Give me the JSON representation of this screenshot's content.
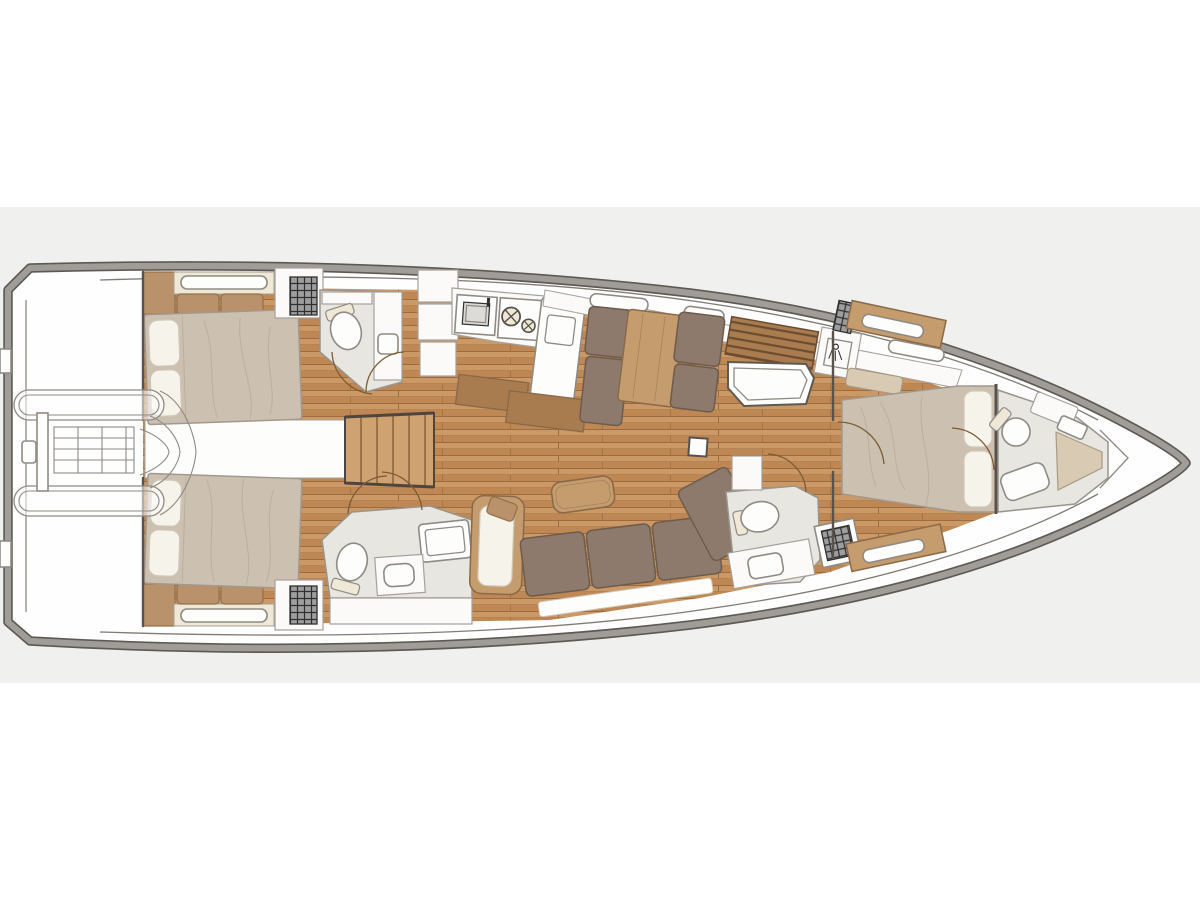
{
  "plan": {
    "type": "sailing-yacht-interior-floor-plan",
    "orientation": "bow-right"
  },
  "colors": {
    "background": "#ffffff",
    "band": "#f0f0ee",
    "hull_fill": "#fefefe",
    "hull_band": "#a09c97",
    "hull_edge": "#5e5952",
    "inner_line": "#807b74",
    "wall": "#57524c",
    "wood_light": "#cc9865",
    "wood_dark": "#bf8753",
    "wood_seam": "#9a6c40",
    "furniture_wood": "#c59c6e",
    "furniture_wood_edge": "#8a6a48",
    "stair_wood": "#cfa371",
    "stair_riser": "#9c7347",
    "stair_rail": "#4e463e",
    "cushion_dark": "#8d7a6c",
    "cushion_dark_edge": "#6d5c4c",
    "cushion_tan": "#b9916a",
    "cushion_tan_edge": "#93704e",
    "duvet": "#ccc0b1",
    "duvet_edge": "#a2988c",
    "pillow": "#f6f3ea",
    "pillow_edge": "#cfc8b8",
    "head_floor": "#e8e6e0",
    "head_floor_edge": "#99948c",
    "fixture": "#fdfdfc",
    "fixture_edge": "#8f8b84",
    "cabinet": "#fbfaf8",
    "cabinet_edge": "#a5a19a",
    "cream": "#efe8d6",
    "hatch_base": "#9e9e9e",
    "hatch_line": "#2f2f2f",
    "slat_base": "#a97c50",
    "slat_line": "#6a4c30",
    "door_arc": "#7d5b35",
    "bench_tan": "#d9cab4",
    "bench_tan_edge": "#a99a84",
    "outline_thin": "#8f8b84",
    "crease": "#b9ac9b",
    "sink_basin": "#dcdbd7",
    "burner": "#55524c"
  }
}
